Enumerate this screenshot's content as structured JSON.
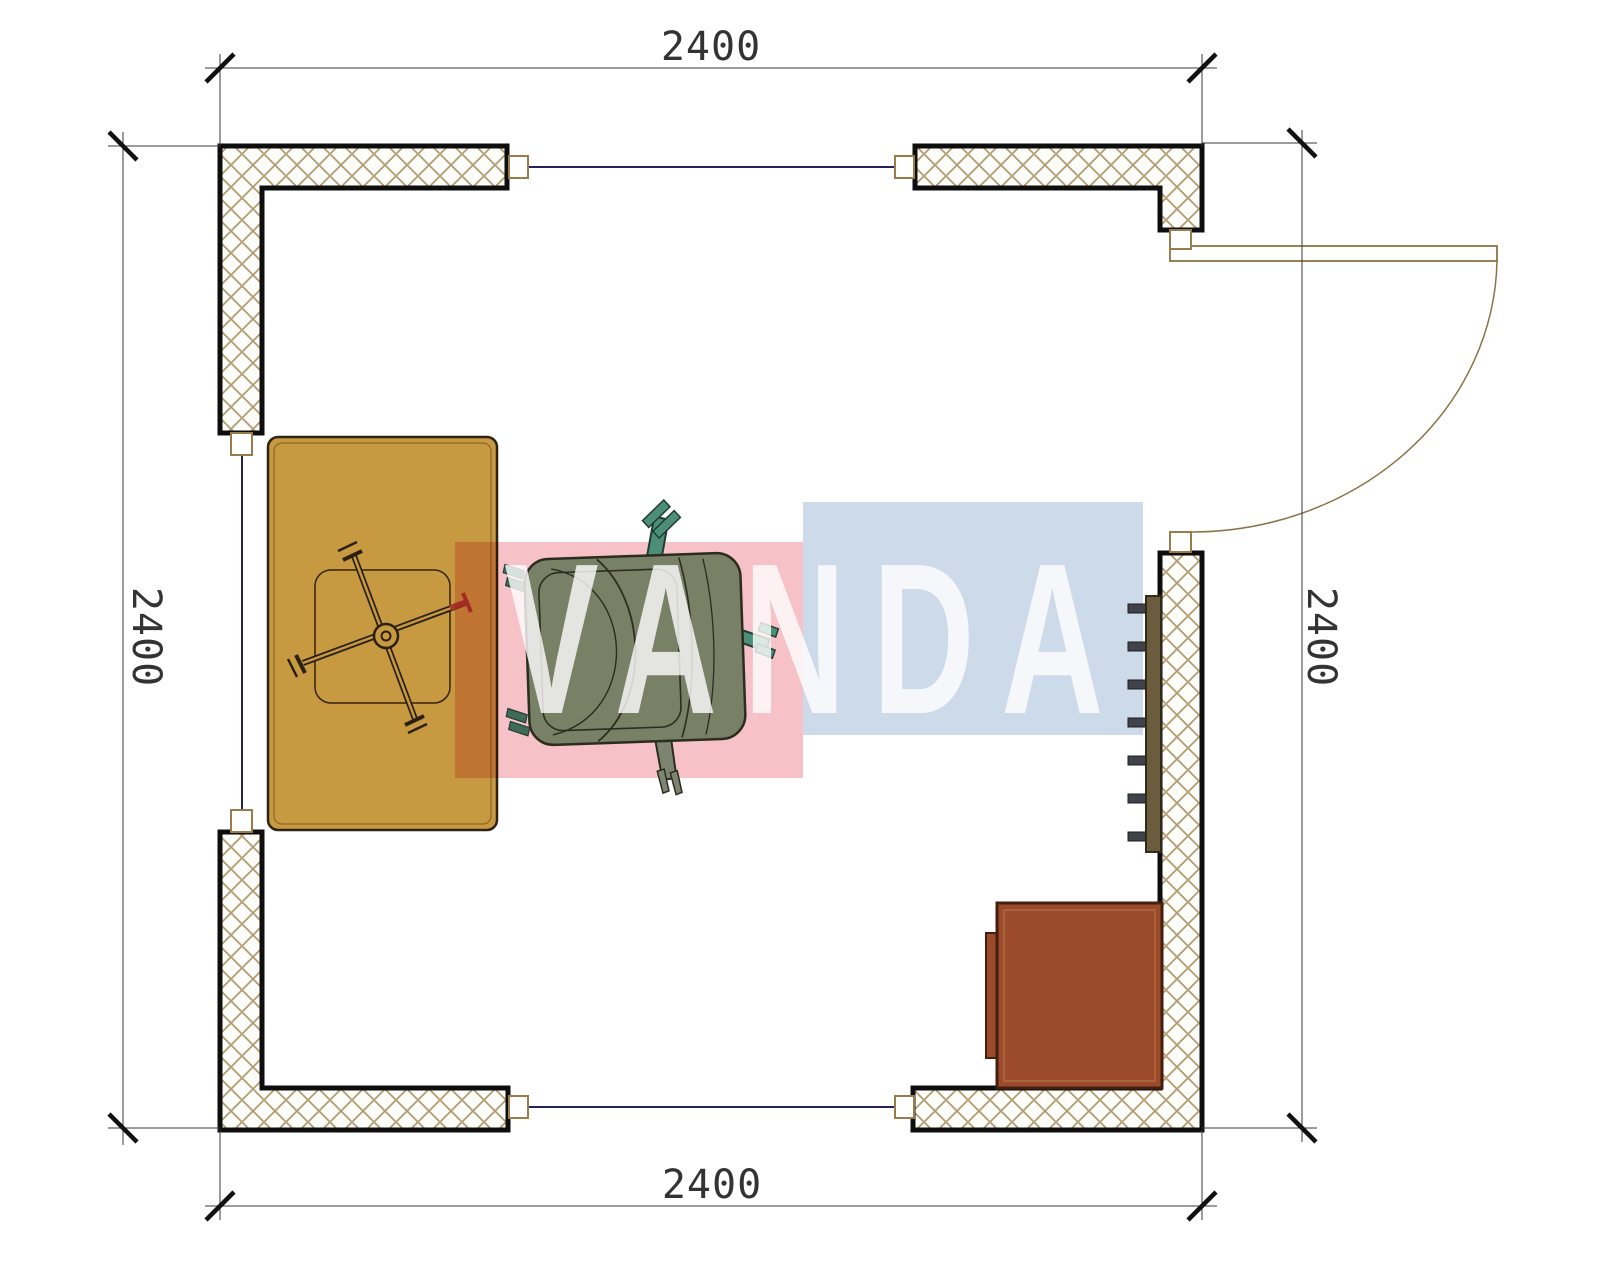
{
  "drawing": {
    "watermark": {
      "text": "VANDA",
      "red_block_color": "#f5bdc2",
      "blue_block_color": "#c9d7e8",
      "letter_color": "#ffffff"
    },
    "dimensions": {
      "top": {
        "label": "2400"
      },
      "bottom": {
        "label": "2400"
      },
      "left": {
        "label": "2400"
      },
      "right": {
        "label": "2400"
      }
    },
    "radiator": {
      "tick_count": 7
    },
    "objects": {
      "desk": {
        "color": "#c79940"
      },
      "chair_seat": {
        "color": "#788066"
      },
      "chair_feet": {
        "color": "#4c8f79"
      },
      "cabinet": {
        "color": "#9b4a2a"
      },
      "radiator_bar": {
        "color": "#6b5c3d"
      },
      "wall_hatch_line": {
        "color": "#b29c72"
      },
      "window_glass_line": {
        "color": "#23235a"
      },
      "door_frame_line": {
        "color": "#8a7347"
      },
      "star_base_red_tip": {
        "color": "#a8392a"
      }
    }
  }
}
